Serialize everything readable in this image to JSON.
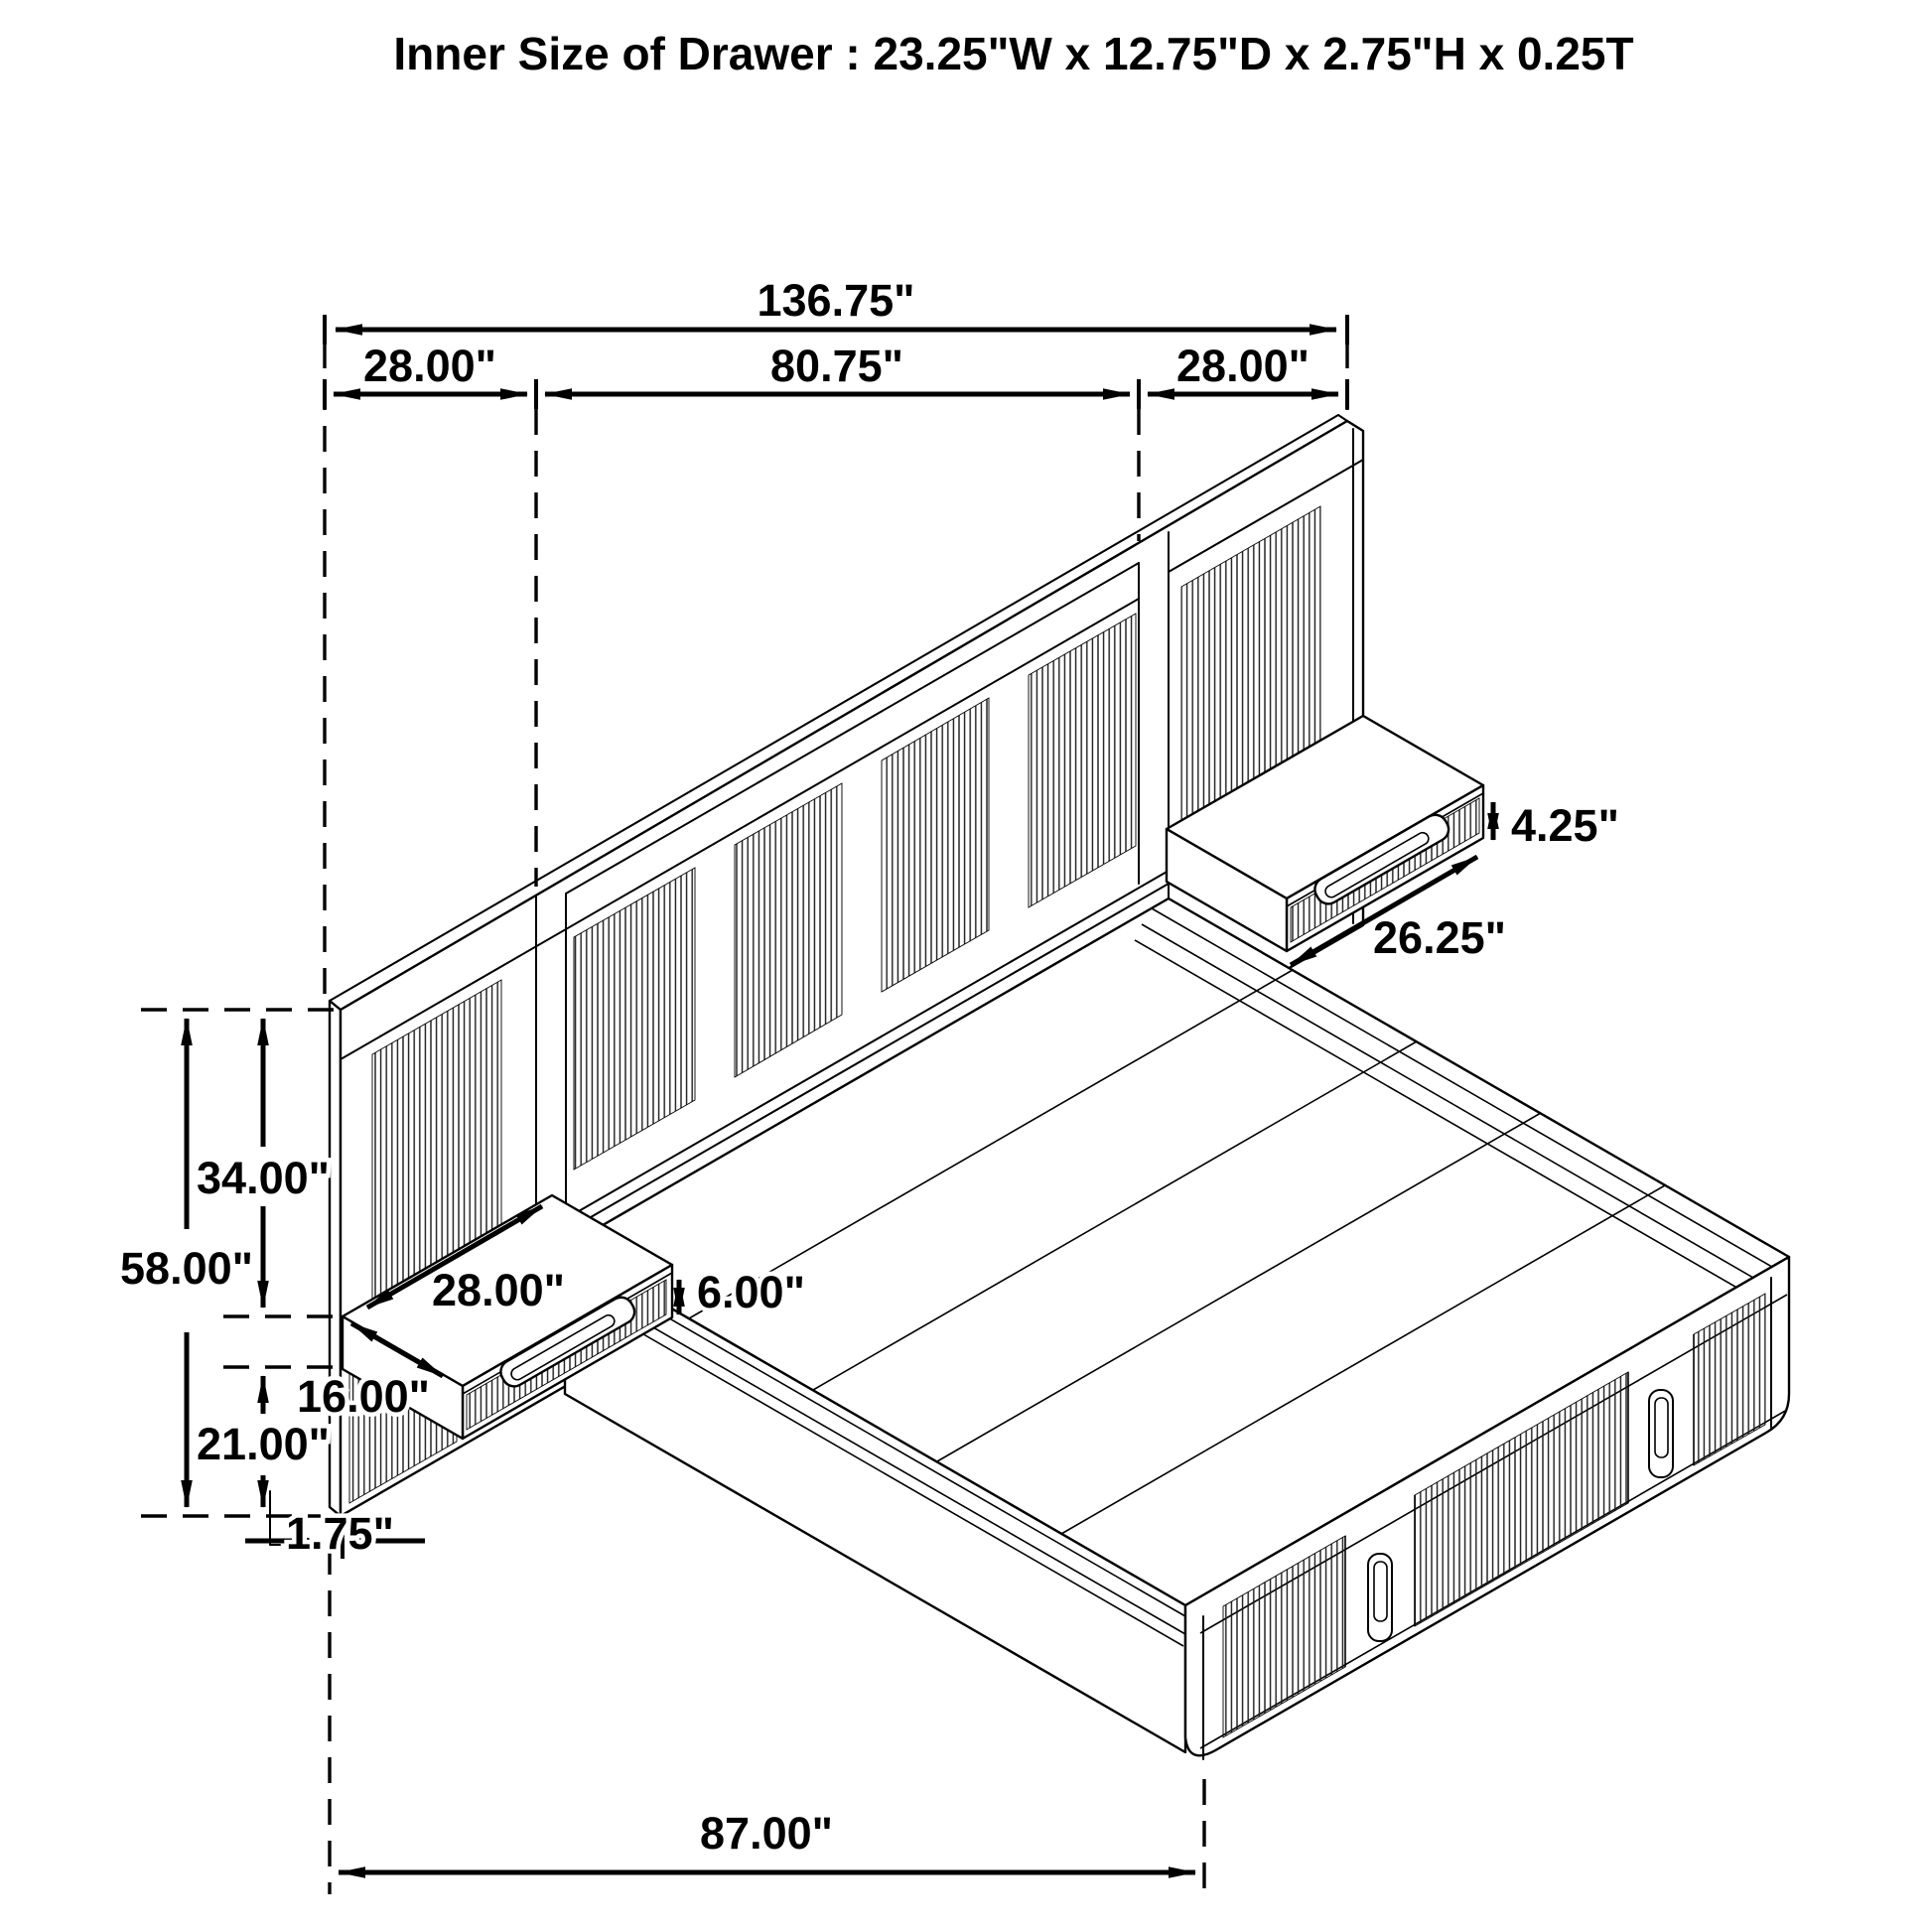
{
  "labels": {
    "title": "Inner Size of Drawer : 23.25\"W x 12.75\"D x 2.75\"H x 0.25T",
    "headboard_total_width": "136.75\"",
    "left_wing_width": "28.00\"",
    "center_section_width": "80.75\"",
    "right_wing_width": "28.00\"",
    "top_to_shelf_height": "34.00\"",
    "headboard_total_height": "58.00\"",
    "shelf_to_floor_height": "21.00\"",
    "shelf_depth": "16.00\"",
    "left_shelf_width": "28.00\"",
    "left_shelf_height": "6.00\"",
    "headboard_thickness": "1.75\"",
    "bed_length": "87.00\"",
    "right_shelf_height": "4.25\"",
    "right_shelf_width": "26.25\""
  },
  "drawing": {
    "type": "isometric-line-drawing",
    "subject": "wall bed with slatted headboard, two floating nightstand drawers and storage platform",
    "line_color": "#000000",
    "background_color": "#ffffff"
  }
}
